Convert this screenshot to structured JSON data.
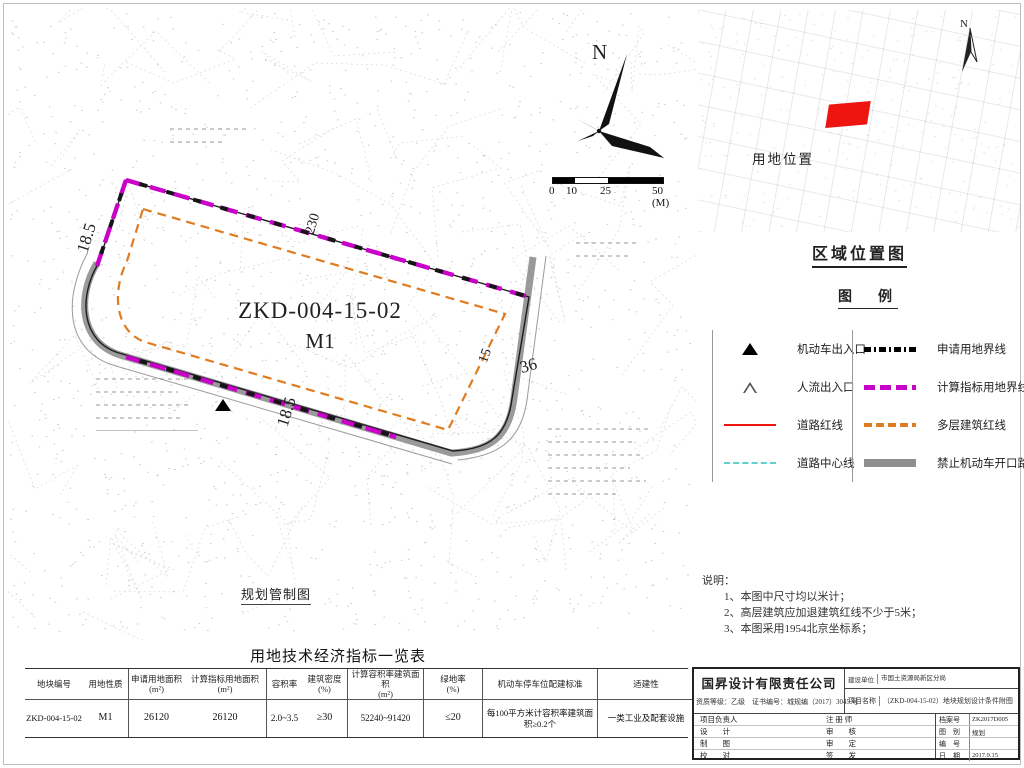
{
  "colors": {
    "magenta": "#c800c8",
    "orange": "#e07b20",
    "roadGray": "#8f8f8f",
    "red": "#ee1511",
    "cyan": "#5fd0d0"
  },
  "map": {
    "plot_code": "ZKD-004-15-02",
    "plot_use": "M1",
    "dim_left": "18.5",
    "dim_top": "230",
    "dim_bottom": "18.5",
    "dim_setback": "15",
    "dim_road": "36",
    "caption": "规划管制图",
    "north_label": "N",
    "scale_ticks": [
      "0",
      "10",
      "25",
      "50 (M)"
    ]
  },
  "inset": {
    "title": "用地位置",
    "north_label": "N"
  },
  "region": {
    "title": "区域位置图",
    "legend_title": "图　例",
    "legend_left": [
      {
        "label": "机动车出入口"
      },
      {
        "label": "人流出入口"
      },
      {
        "label": "道路红线"
      },
      {
        "label": "道路中心线"
      }
    ],
    "legend_right": [
      {
        "label": "申请用地界线"
      },
      {
        "label": "计算指标用地界线"
      },
      {
        "label": "多层建筑红线"
      },
      {
        "label": "禁止机动车开口路段"
      }
    ]
  },
  "notes": {
    "title": "说明：",
    "items": [
      "1、本图中尺寸均以米计；",
      "2、高层建筑应加退建筑红线不少于5米；",
      "3、本图采用1954北京坐标系；"
    ]
  },
  "table": {
    "title": "用地技术经济指标一览表",
    "headers": [
      {
        "a": "地块编号",
        "b": ""
      },
      {
        "a": "用地性质",
        "b": ""
      },
      {
        "a": "申请用地面积",
        "b": "(m²)"
      },
      {
        "a": "计算指标用地面积",
        "b": "(m²)"
      },
      {
        "a": "容积率",
        "b": ""
      },
      {
        "a": "建筑密度",
        "b": "(%)"
      },
      {
        "a": "计算容积率建筑面积",
        "b": "(m²)"
      },
      {
        "a": "绿地率",
        "b": "(%)"
      },
      {
        "a": "机动车停车位配建标准",
        "b": ""
      },
      {
        "a": "适建性",
        "b": ""
      }
    ],
    "row": [
      "ZKD-004-15-02",
      "M1",
      "26120",
      "26120",
      "2.0~3.5",
      "≥30",
      "52240~91420",
      "≤20",
      "每100平方米计容积率建筑面积≥0.2个",
      "一类工业及配套设施"
    ]
  },
  "titleblock": {
    "company": "国昇设计有限责任公司",
    "credential": "资质等级：乙级　证书编号：城规编（2017）3045 号",
    "client_label": "建设单位",
    "client_value": "市国土资源局新区分局",
    "project_label": "项目名称",
    "project_value": "（ZKD-004-15-02）地块规划设计条件附图",
    "roles": [
      [
        "项目负责人",
        "注 册 师"
      ],
      [
        "设　　计",
        "审　　核"
      ],
      [
        "制　　图",
        "审　　定"
      ],
      [
        "校　　对",
        "签　　发"
      ]
    ],
    "mini": [
      {
        "label": "档案号",
        "value": "ZK2017D005"
      },
      {
        "label": "图　别",
        "value": "规划"
      },
      {
        "label": "编　号",
        "value": ""
      },
      {
        "label": "日　期",
        "value": "2017.9.15"
      }
    ]
  }
}
